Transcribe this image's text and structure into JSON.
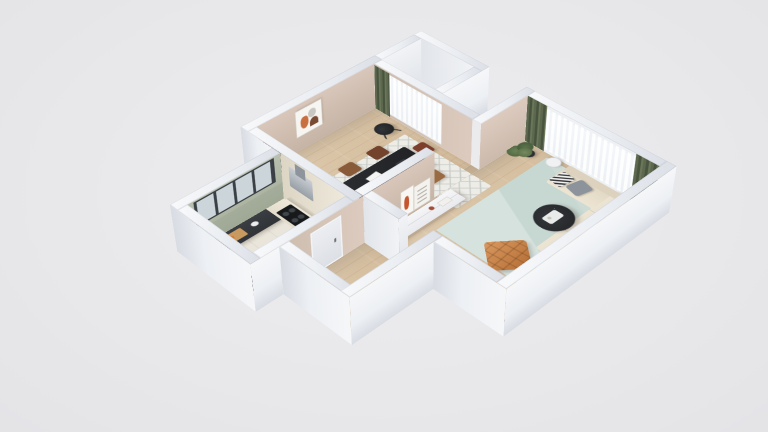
{
  "scene": {
    "type": "3d-floor-plan",
    "style": "isometric cutaway render of a one-bedroom apartment",
    "background": "#e9e9eb"
  },
  "colors": {
    "beige": "#d8c7ba",
    "beige-dark": "#c6b4a6",
    "sage": "#b9c0af",
    "cream": "#efe9dc",
    "wood": "#d9c2a2",
    "rug-teal": "#c7d8d2",
    "curtain": "#57624e",
    "curtain-dark": "#49543f",
    "orange": "#c67c3e",
    "yellow": "#eec235",
    "black-furniture": "#26282b",
    "glass": "#fbfcfe",
    "wall-white": "#f3f4f7"
  },
  "rooms": [
    {
      "name": "dining-room",
      "walls": "beige",
      "items": [
        "black-dining-table",
        "wood-chairs",
        "yellow-cushion-chair",
        "white-trellis-rug",
        "black-tripod-floor-lamp",
        "abstract-wall-art",
        "window-sheer-curtains",
        "green-curtain",
        "wall-tv"
      ]
    },
    {
      "name": "kitchen",
      "walls": "sage-green",
      "items": [
        "glass-front-upper-cabinets",
        "dark-countertop",
        "range-hood",
        "black-cooktop",
        "sink",
        "cutting-board",
        "dark-fridge"
      ]
    },
    {
      "name": "hallway",
      "walls": "beige",
      "items": [
        "entry-door"
      ]
    },
    {
      "name": "living-room",
      "walls": "beige",
      "items": [
        "cream-corner-sofa",
        "gray-pillow",
        "patterned-pillow",
        "teal-rug",
        "black-round-coffee-table",
        "orange-tufted-lounge-chair",
        "white-tv-console",
        "leaning-art-frames",
        "potted-plant",
        "black-metal-shelf",
        "white-floor-basket",
        "sheepskin-rug",
        "window-sheer-curtains",
        "green-curtains"
      ]
    },
    {
      "name": "balcony",
      "walls": "white",
      "items": [
        "white-bench-tub"
      ]
    }
  ]
}
